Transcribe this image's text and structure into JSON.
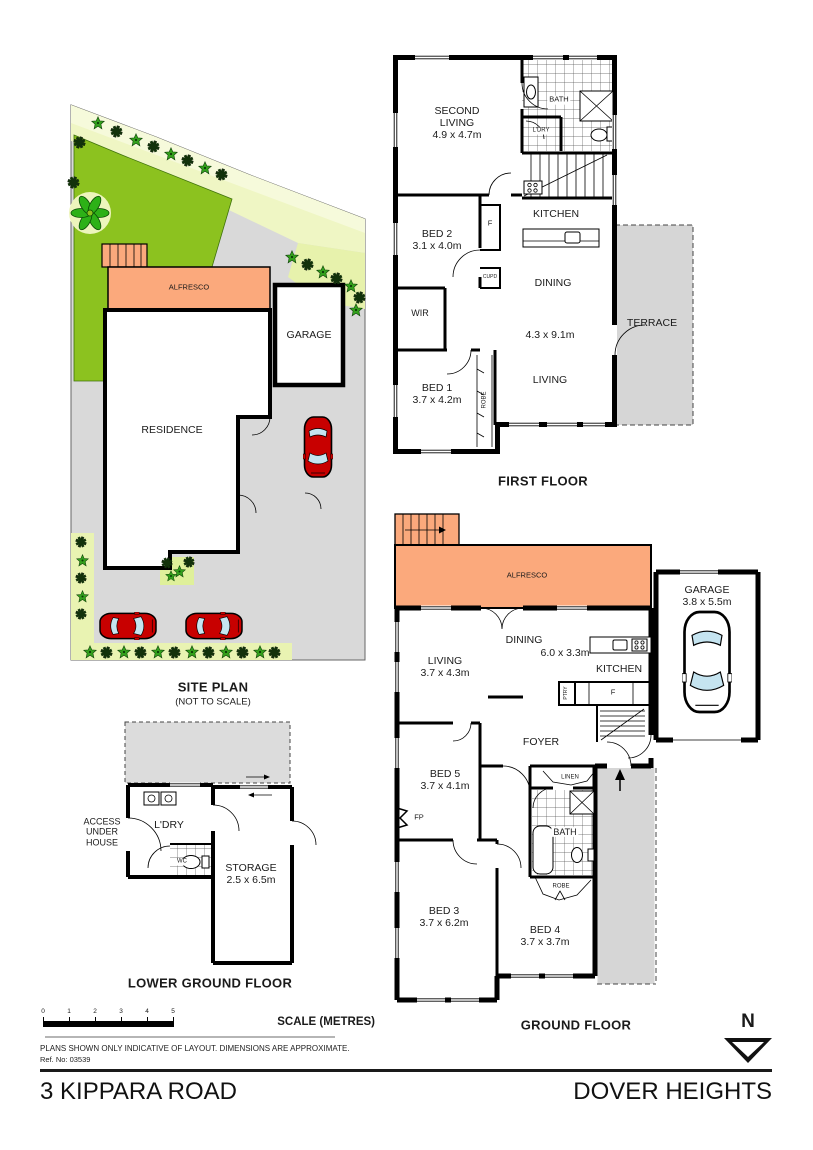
{
  "page": {
    "address": "3 KIPPARA ROAD",
    "suburb": "DOVER HEIGHTS",
    "disclaimer": "PLANS SHOWN ONLY INDICATIVE OF LAYOUT.  DIMENSIONS ARE APPROXIMATE.",
    "ref": "Ref. No: 03539",
    "north": "N",
    "scale": {
      "label": "SCALE (METRES)",
      "ticks": [
        "0",
        "1",
        "2",
        "3",
        "4",
        "5"
      ]
    }
  },
  "site_plan": {
    "title": "SITE PLAN",
    "subtitle": "(NOT TO SCALE)",
    "alfresco": "ALFRESCO",
    "garage": "GARAGE",
    "residence": "RESIDENCE"
  },
  "first_floor": {
    "title": "FIRST FLOOR",
    "second_living": "SECOND LIVING",
    "second_living_dims": "4.9 x 4.7m",
    "bath": "BATH",
    "ldry": "L'DRY",
    "bed2": "BED 2",
    "bed2_dims": "3.1 x 4.0m",
    "f": "F",
    "cupd": "CUPD",
    "kitchen": "KITCHEN",
    "dining": "DINING",
    "dining_dims": "4.3 x 9.1m",
    "living": "LIVING",
    "wir": "WIR",
    "bed1": "BED 1",
    "bed1_dims": "3.7 x 4.2m",
    "robe": "ROBE",
    "terrace": "TERRACE"
  },
  "ground_floor": {
    "title": "GROUND FLOOR",
    "alfresco": "ALFRESCO",
    "garage": "GARAGE",
    "garage_dims": "3.8 x 5.5m",
    "dining": "DINING",
    "dining_dims": "6.0 x 3.3m",
    "living": "LIVING",
    "living_dims": "3.7 x 4.3m",
    "kitchen": "KITCHEN",
    "f": "F",
    "ptry": "PTRY",
    "foyer": "FOYER",
    "bed5": "BED 5",
    "bed5_dims": "3.7 x 4.1m",
    "fp": "FP",
    "linen": "LINEN",
    "bath": "BATH",
    "robe": "ROBE",
    "bed3": "BED 3",
    "bed3_dims": "3.7 x 6.2m",
    "bed4": "BED 4",
    "bed4_dims": "3.7 x 3.7m"
  },
  "lower_ground": {
    "title": "LOWER GROUND FLOOR",
    "access": "ACCESS\nUNDER\nHOUSE",
    "ldry": "L'DRY",
    "wc": "WC",
    "storage": "STORAGE",
    "storage_dims": "2.5 x 6.5m"
  },
  "colors": {
    "alfresco": "#FBA97C",
    "lawn": "#8CC21F",
    "garden": "#E9F3B2",
    "paving": "#D9D9D9",
    "car": "#C80000"
  }
}
